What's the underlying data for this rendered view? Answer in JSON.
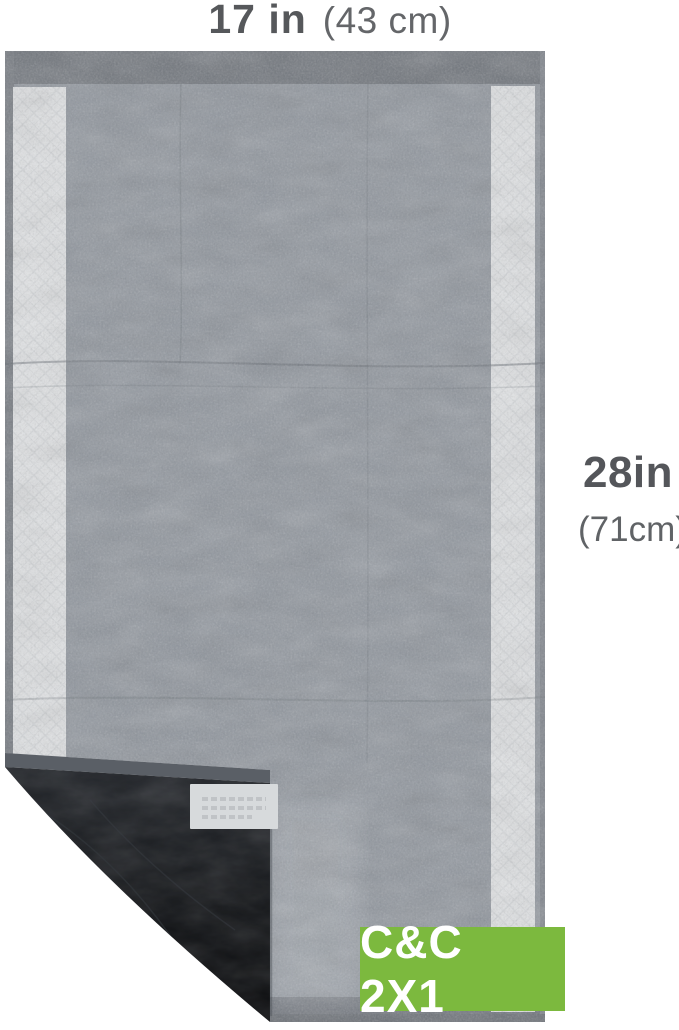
{
  "labels": {
    "width": {
      "imperial": "17 in",
      "metric": "(43 cm)"
    },
    "height": {
      "imperial": "28in",
      "metric": "(71cm)"
    }
  },
  "badge": {
    "label": "C&C 2X1",
    "background": "#7cb93e",
    "text_color": "#ffffff"
  },
  "pad_colors": {
    "surface": "#8f959d",
    "border": "#70757c",
    "absorbent_strip": "#e2e4e6",
    "backing": "#131518",
    "sticker": "#d7dadc"
  }
}
